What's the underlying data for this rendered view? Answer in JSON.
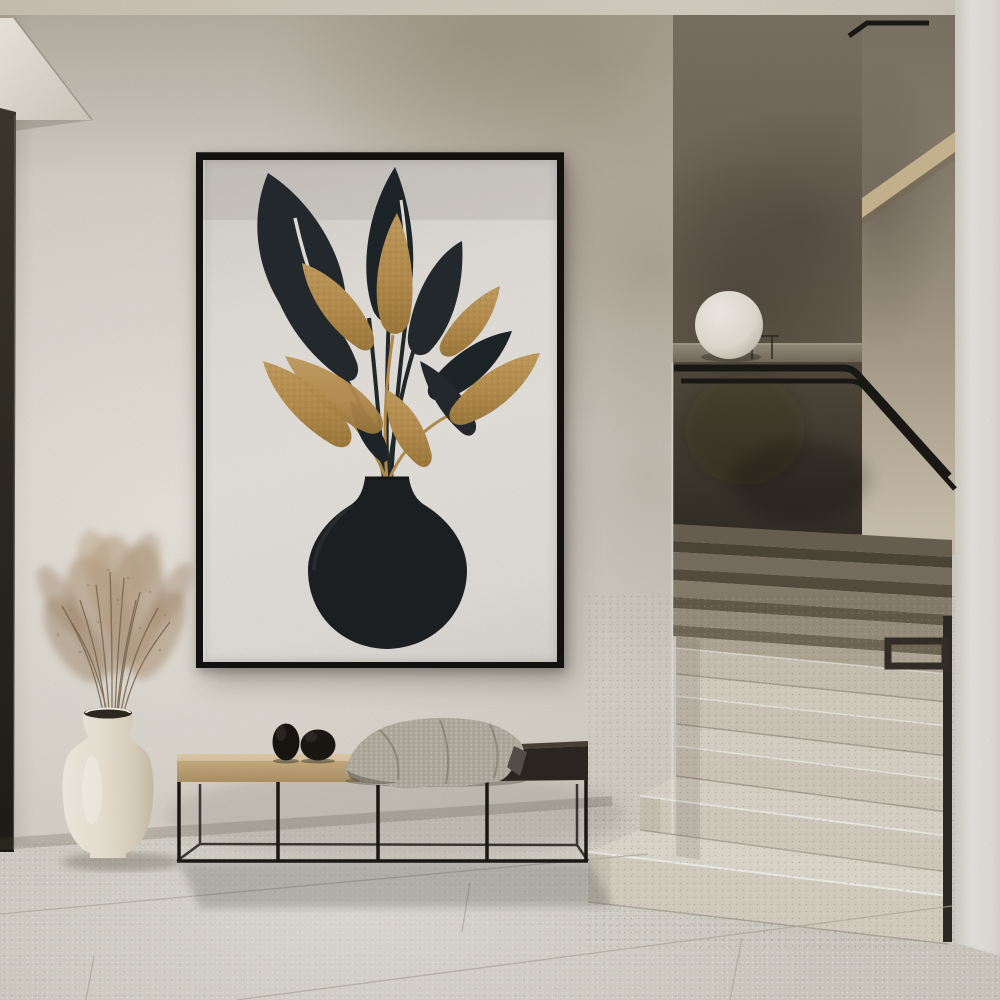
{
  "scene": {
    "type": "interior-photograph",
    "description": "minimalist-hallway-with-framed-botanical-print-and-staircase",
    "objects": {
      "art_print": "black-and-gold-leaves-in-black-vase",
      "frame": "thin-black-poster-frame",
      "bench": "metal-frame-bench-with-oak-and-dark-top",
      "throw": "knitted-beige-throw-blanket",
      "stones": "two-black-decor-stones",
      "floor_vase": "white-ceramic-vase",
      "plant": "dried-pampas-grass",
      "lamp": "white-sphere-lamp-on-ledge",
      "stairs": "terrazzo-staircase-with-black-handrail",
      "door_edge": "dark-door-reveal-left",
      "column": "white-wall-column-right"
    }
  },
  "palette": {
    "ceiling": "#d3ccbf",
    "wall": "#d6d1c8",
    "backwall": "#6e6558",
    "sidewall_top": "#7e7567",
    "sidewall_bottom": "#cfc4b1",
    "column": "#e9e7e2",
    "floor": "#cbc7be",
    "frame": "#141210",
    "art_bg": "#e9e6e1",
    "leaf_dark": "#242b2e",
    "leaf_gold": "#b98f4f",
    "leaf_gold_light": "#caa363",
    "art_vase": "#1e2124",
    "door_edge": "#332f27",
    "bench_wood": "#c4a97c",
    "bench_dark": "#2c2722",
    "metal": "#1b1915",
    "blanket": "#b6afa3",
    "stone": "#191511",
    "white_vase": "#eee7d8",
    "pampas": "#b29a80",
    "ledge": "#8d8373",
    "step_dark": "#7a7161",
    "step_light": "#d9d3c5",
    "handrail": "#1c1a16",
    "lamp": "#f0ece4"
  }
}
